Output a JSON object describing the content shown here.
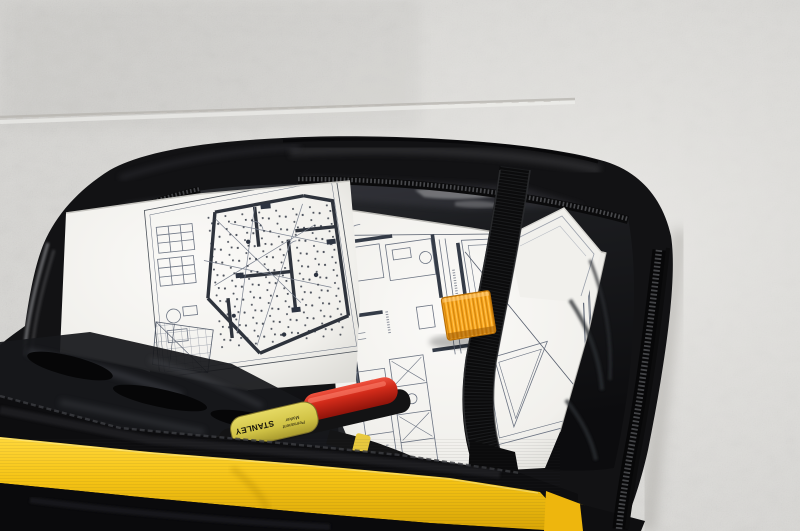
{
  "scene": {
    "description": "Open black Stanley document tool bag with yellow trim lying against a white painted concrete wall; inside are folded architectural floor-plan blueprints, a black webbing strap with an orange tab, and a Stanley permanent marker with a red cap."
  },
  "marker": {
    "brand": "STANLEY",
    "label_line1": "Permanent",
    "label_line2": "Marker"
  },
  "colors": {
    "wall": "#d9d8d5",
    "mortar_line": "#b5b3ae",
    "bag_black": "#111113",
    "bag_yellow": "#f2bf17",
    "tab_orange": "#f8a41b",
    "strap_black": "#0c0c0d",
    "marker_body_yellow": "#d9cb50",
    "marker_cap_red": "#ce2a1c",
    "paper": "#f5f4f1",
    "blueprint_line": "#5d6674"
  }
}
